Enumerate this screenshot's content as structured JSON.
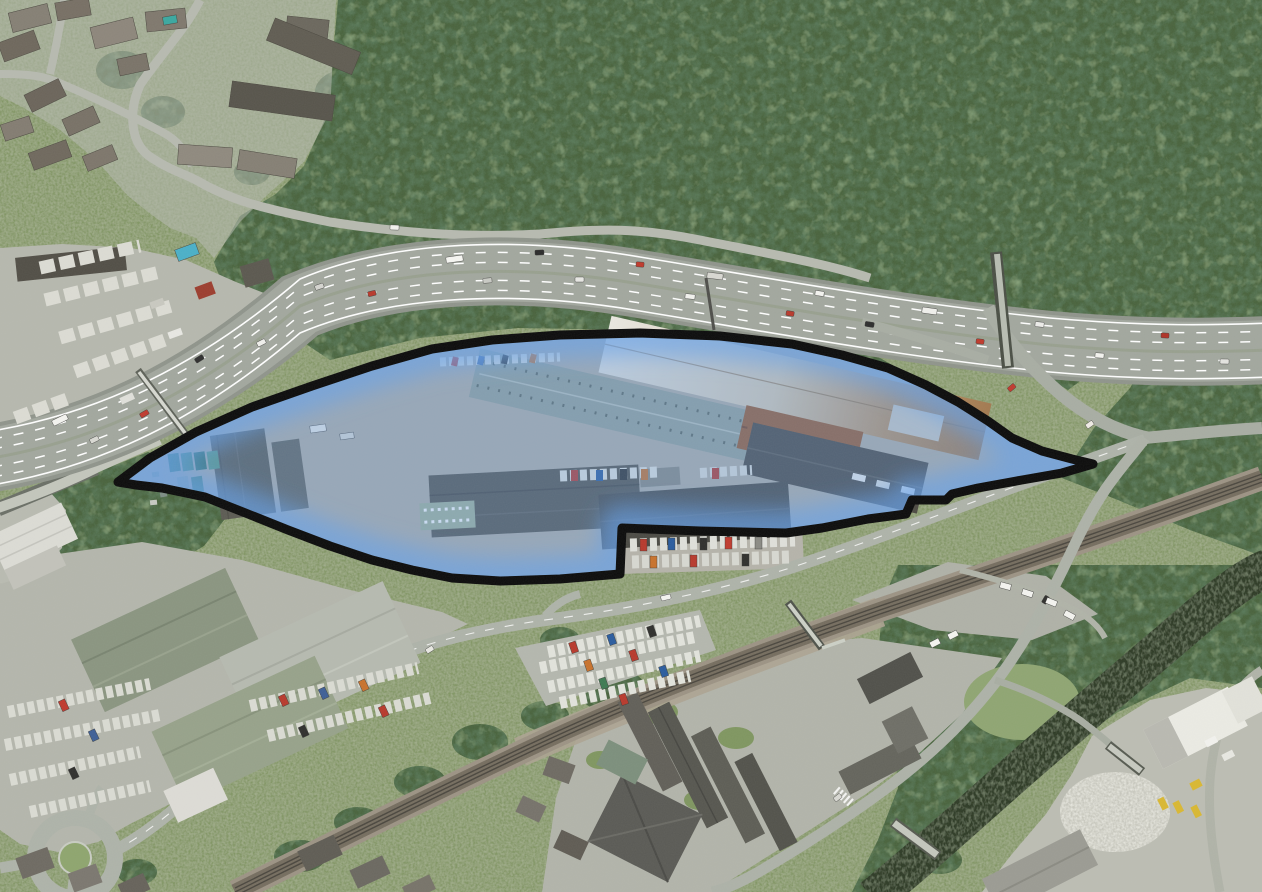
{
  "meta": {
    "type": "aerial-photograph-site-plan",
    "description": "Aerial photograph of an industrial estate between a motorway and a railway line, with the development site highlighted by a blue shaded polygon and a thick black boundary line",
    "width": 1262,
    "height": 892
  },
  "site_boundary": {
    "label": "highlighted-site-industrial-estate",
    "polygon_points": "118,482 150,458 196,432 252,407 312,386 372,366 432,349 492,340 560,335 640,333 720,336 792,344 842,355 888,368 926,385 958,402 988,421 1012,438 1042,451 1072,459 1093,464 1062,473 1022,480 978,488 952,494 946,500 912,500 906,514 868,519 822,528 786,533 700,531 622,528 620,574 560,579 500,581 452,578 412,570 372,560 330,546 288,530 248,514 205,497 162,488 136,485",
    "outline_color": "#0b0b0b",
    "outline_width": 9,
    "fill_color": "#6296da",
    "fill_opacity": 0.34,
    "glow_color": "#66a1eb",
    "glow_width": 46,
    "glow_opacity": 0.6
  },
  "scene": {
    "base_grass_color": "#7e9161",
    "woodland_color": "#49643c",
    "motorway_surface_color": "#a2a79e",
    "lane_marking_color": "#ffffff",
    "road_color": "#aeb3a9",
    "railway_color": "#6f6759",
    "river_color": "#2e3a28",
    "concrete_color": "#b4b6ac",
    "landmarks": [
      "woodland-hillside-north",
      "residential-area-top-left",
      "motorway-dual-carriageway",
      "truck-depot-west",
      "industrial-estate-site",
      "slip-road-junction-east",
      "railway-line",
      "large-car-park",
      "warehouses-south-west",
      "roundabout",
      "terraced-housing-south",
      "river-south-east",
      "scrapyard-south-east"
    ]
  }
}
